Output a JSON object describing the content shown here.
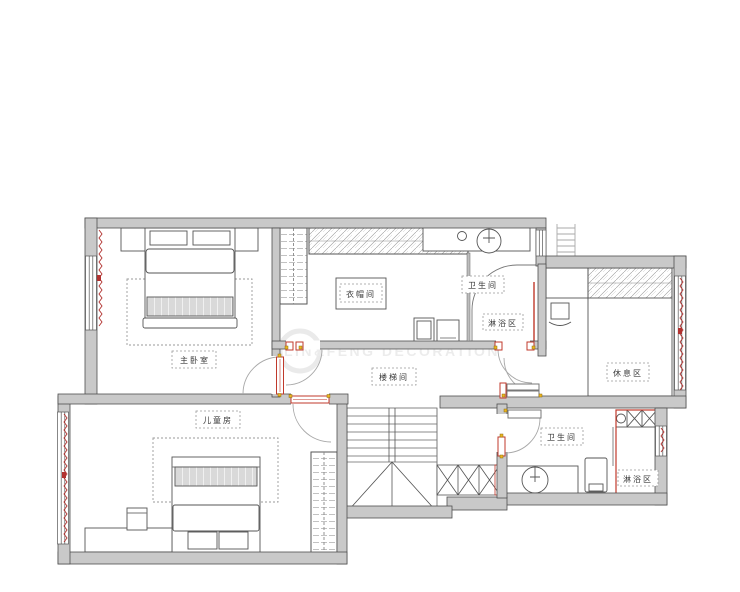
{
  "title": "second-floor residential floor plan",
  "watermark": {
    "brand": "LIN&FENG DECORATION"
  },
  "rooms": {
    "master_bedroom": {
      "label": "主卧室"
    },
    "cloakroom": {
      "label": "衣帽间"
    },
    "bathroom_upper": {
      "label": "卫生间"
    },
    "shower_upper": {
      "label": "淋浴区"
    },
    "stairwell": {
      "label": "楼梯间"
    },
    "rest_area": {
      "label": "休息区"
    },
    "kids_room": {
      "label": "儿童房"
    },
    "bathroom_lower": {
      "label": "卫生间"
    },
    "shower_lower": {
      "label": "淋浴区"
    }
  },
  "colors": {
    "wall_fill": "#c9c9c9",
    "wall_stroke": "#4f4f4f",
    "accent_red": "#c0392b",
    "hinge_yellow": "#edb51e",
    "line_grey": "#555555"
  }
}
